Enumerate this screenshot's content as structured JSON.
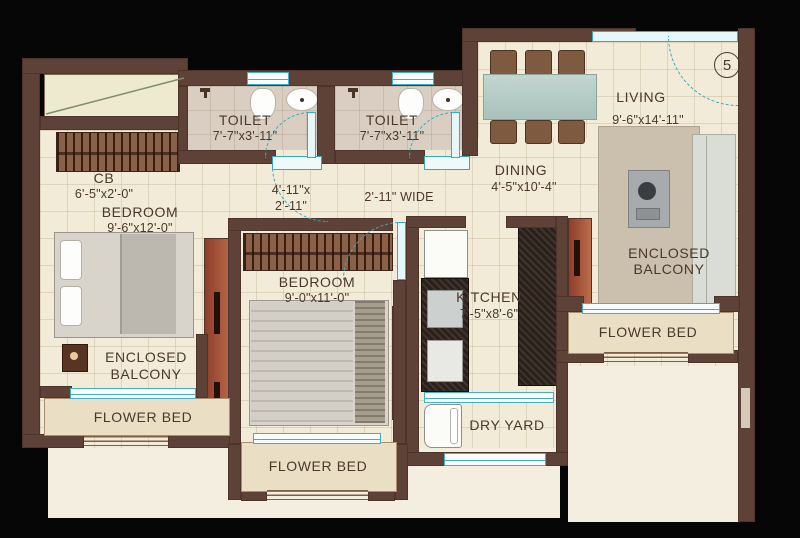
{
  "plan": {
    "unit_number": "5",
    "labels": {
      "toilet_1": {
        "name": "TOILET",
        "dims": "7'-7\"x3'-11\""
      },
      "toilet_2": {
        "name": "TOILET",
        "dims": "7'-7\"x3'-11\""
      },
      "living": {
        "name": "LIVING",
        "dims": "9'-6\"x14'-11\""
      },
      "dining": {
        "name": "DINING",
        "dims": "4'-5\"x10'-4\""
      },
      "cupboard": {
        "name": "CB",
        "dims": "6'-5\"x2'-0\""
      },
      "bedroom_1": {
        "name": "BEDROOM",
        "dims": "9'-6\"x12'-0\""
      },
      "bedroom_2": {
        "name": "BEDROOM",
        "dims": "9'-0\"x11'-0\""
      },
      "kitchen": {
        "name": "KITCHEN",
        "dims": "7'-5\"x8'-6\""
      },
      "balcony_left": {
        "line1": "ENCLOSED",
        "line2": "BALCONY"
      },
      "balcony_right": {
        "line1": "ENCLOSED",
        "line2": "BALCONY"
      },
      "flower_bed_left": "FLOWER BED",
      "flower_bed_center": "FLOWER BED",
      "flower_bed_right": "FLOWER BED",
      "dry_yard": "DRY YARD",
      "passage": {
        "line1": "4'-11\"x",
        "line2": "2'-11\""
      },
      "corridor_width": "2'-11\" WIDE"
    },
    "colors": {
      "wall": "#5e4237",
      "floor": "#f2ebd8",
      "toilet_floor": "#d9cec1",
      "flower_bed": "#eadfc5",
      "window": "#45aec6",
      "door_arc": "#3aa8bd",
      "shaft_red": "#a85238",
      "text": "#4a382b"
    }
  }
}
